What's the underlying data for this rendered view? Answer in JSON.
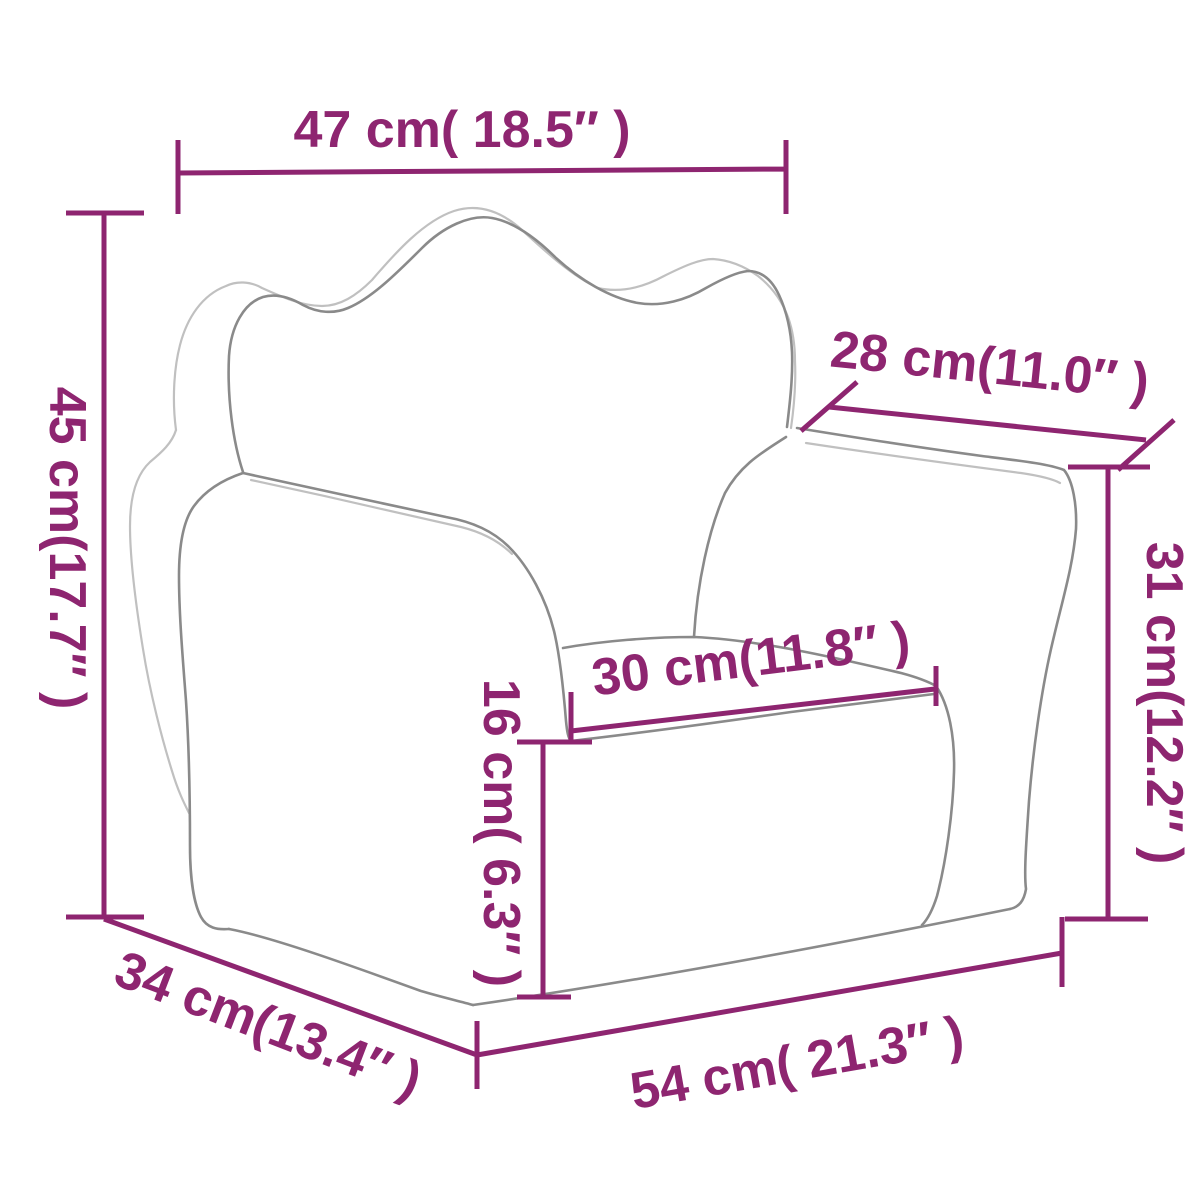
{
  "diagram": {
    "subject": "kids-armchair-dimension-drawing",
    "colors": {
      "dimension_accent": "#8e2570",
      "outline_main": "#8a8a8a",
      "outline_light": "#c0c0c0",
      "background": "#ffffff"
    },
    "measurements": [
      {
        "id": "back-width",
        "value_cm": 47,
        "value_in": 18.5,
        "label": "47 cm( 18.5″ )"
      },
      {
        "id": "back-height",
        "value_cm": 45,
        "value_in": 17.7,
        "label": "45 cm(17.7″ )"
      },
      {
        "id": "arm-depth",
        "value_cm": 28,
        "value_in": 11.0,
        "label": "28 cm(11.0″ )"
      },
      {
        "id": "arm-height",
        "value_cm": 31,
        "value_in": 12.2,
        "label": "31 cm(12.2″ )"
      },
      {
        "id": "seat-width",
        "value_cm": 30,
        "value_in": 11.8,
        "label": "30 cm(11.8″ )"
      },
      {
        "id": "seat-front-height",
        "value_cm": 16,
        "value_in": 6.3,
        "label": "16 cm( 6.3″ )"
      },
      {
        "id": "base-depth",
        "value_cm": 34,
        "value_in": 13.4,
        "label": "34 cm(13.4″ )"
      },
      {
        "id": "base-width",
        "value_cm": 54,
        "value_in": 21.3,
        "label": "54 cm( 21.3″ )"
      }
    ]
  }
}
